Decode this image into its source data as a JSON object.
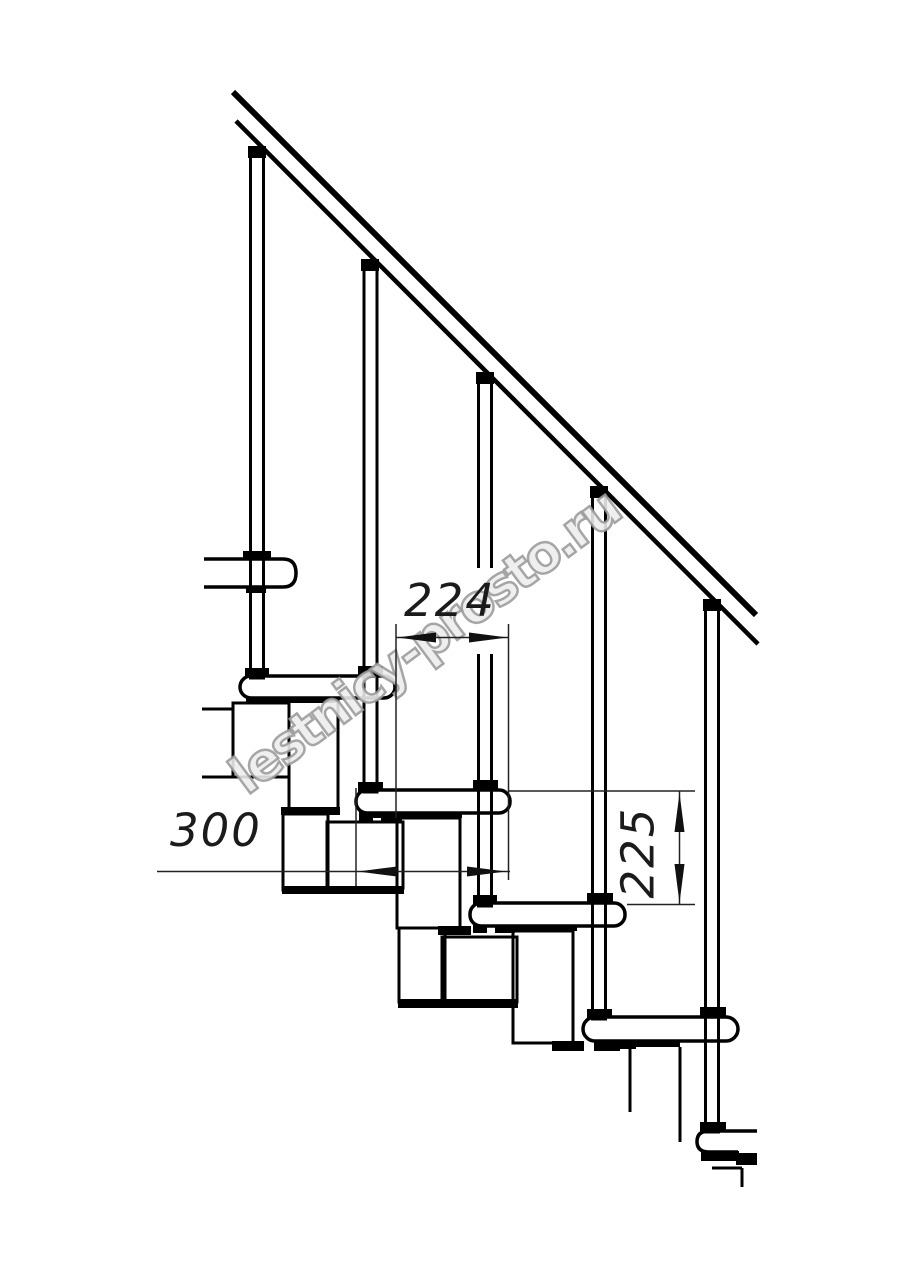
{
  "drawing": {
    "title": "modular-staircase-side-view",
    "dimensions": {
      "going": "224",
      "tread_depth": "300",
      "step_height": "225"
    },
    "watermark": "lestnicy-prosto.ru",
    "colors": {
      "line": "#000000",
      "dim_line": "#222222",
      "watermark_gray": "#989898",
      "background": "#ffffff"
    }
  }
}
